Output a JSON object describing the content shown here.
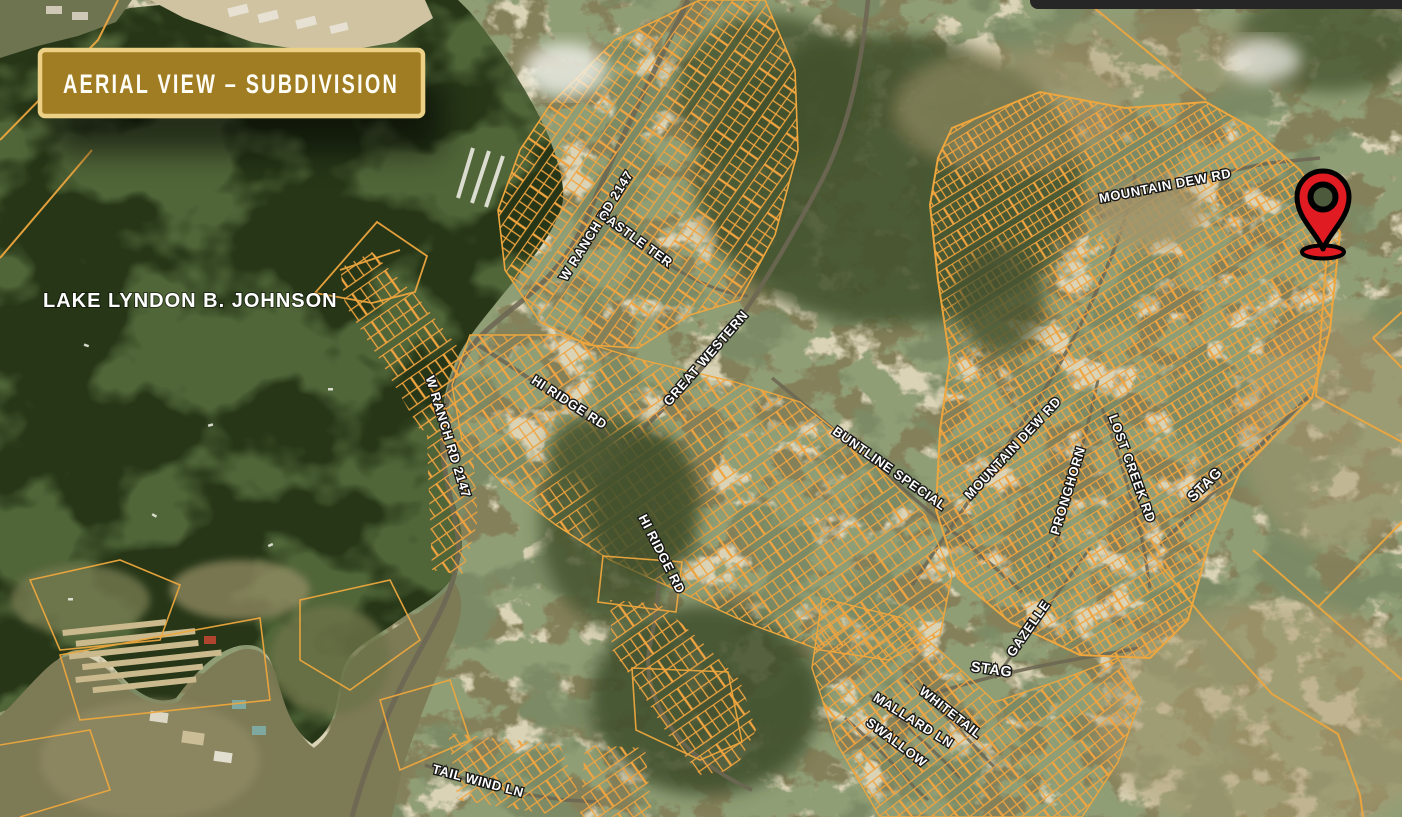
{
  "banner": {
    "title": "AERIAL VIEW – SUBDIVISION"
  },
  "map": {
    "lake_label": "LAKE LYNDON B. JOHNSON",
    "road_labels": [
      {
        "text": "W RANCH RD 2147"
      },
      {
        "text": "CASTLE TER"
      },
      {
        "text": "GREAT WESTERN"
      },
      {
        "text": "HI RIDGE RD"
      },
      {
        "text": "W RANCH RD 2147"
      },
      {
        "text": "HI RIDGE RD"
      },
      {
        "text": "BUNTLINE SPECIAL"
      },
      {
        "text": "MOUNTAIN DEW RD"
      },
      {
        "text": "PRONGHORN"
      },
      {
        "text": "LOST CREEK RD"
      },
      {
        "text": "STAG"
      },
      {
        "text": "GAZELLE"
      },
      {
        "text": "STAG"
      },
      {
        "text": "WHITETAIL"
      },
      {
        "text": "MALLARD LN"
      },
      {
        "text": "SWALLOW"
      },
      {
        "text": "TAIL WIND LN"
      },
      {
        "text": "MOUNTAIN DEW RD"
      }
    ],
    "marker": {
      "type": "location-pin",
      "fill": "#e01b22",
      "outline": "#000000"
    },
    "colors": {
      "parcel_line": "#f1a43f",
      "lake": "#263617",
      "banner_fill": "#a07c22",
      "banner_border": "#ecd085",
      "label_text": "#ffffff"
    }
  }
}
